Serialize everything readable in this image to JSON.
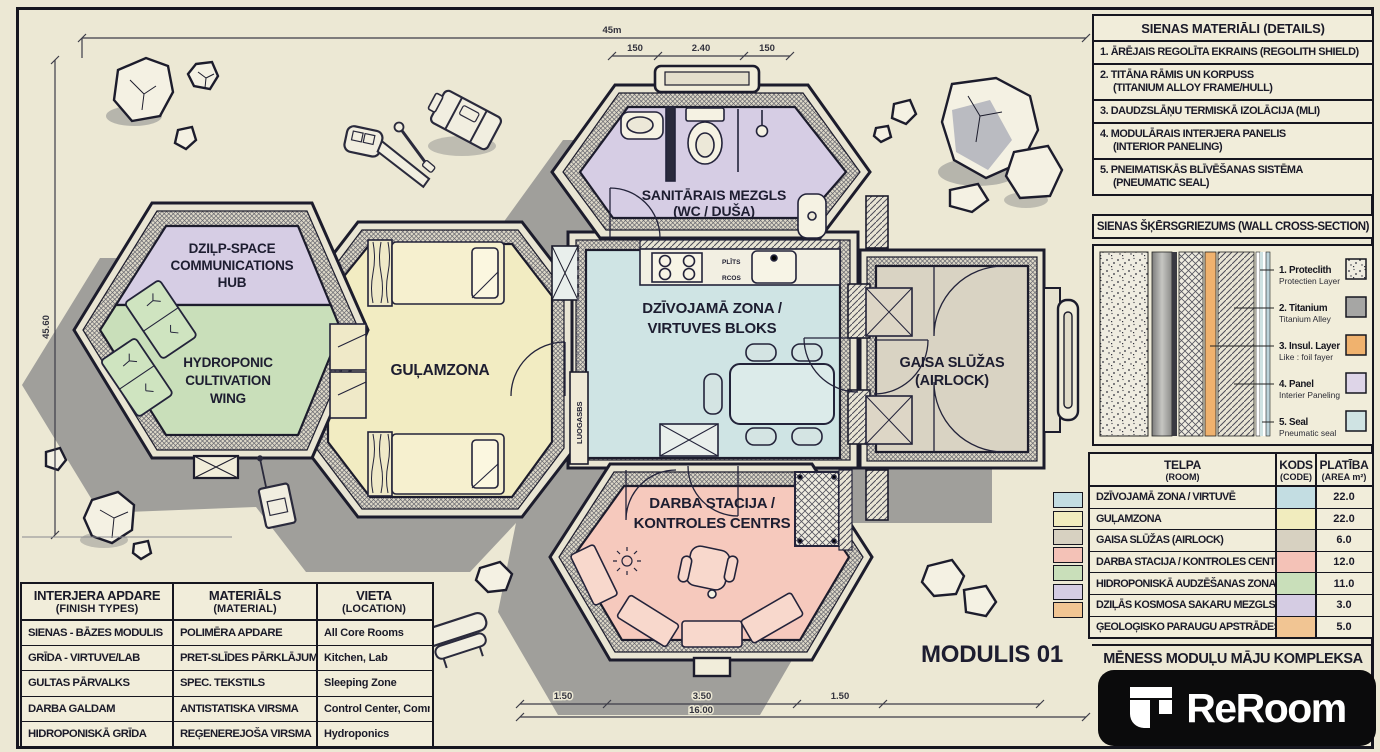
{
  "colors": {
    "paper": "#ede9d6",
    "ink": "#1c1c2c",
    "living": "#cfe4e4",
    "sleep": "#f2ecc2",
    "airlock": "#d9d3c3",
    "work": "#f6c9bd",
    "hydro": "#c9dfba",
    "comms": "#d6cde4",
    "sw_living": "#c3dde2",
    "sw_sleep": "#f1ecbe",
    "sw_airlock": "#d7d1c1",
    "sw_work": "#f4c2b7",
    "sw_hydro": "#c9dfba",
    "sw_comms": "#d5cce3",
    "sw_lab": "#f1c593",
    "cs_titanium": "#a6a6a4",
    "cs_insul": "#f0b26e",
    "cs_panel": "#ded5e8",
    "cs_seal": "#cfe3e3"
  },
  "plan": {
    "module_label": "MODULIS 01",
    "rooms": {
      "comms1": "DZIĻP-SPACE",
      "comms2": "COMMUNICATIONS",
      "comms3": "HUB",
      "hydro1": "HYDROPONIC",
      "hydro2": "CULTIVATION",
      "hydro3": "WING",
      "sleep": "GUĻAMZONA",
      "living1": "DZĪVOJAMĀ ZONA /",
      "living2": "VIRTUVES BLOKS",
      "sanitary1": "SANITĀRAIS MEZGLS",
      "sanitary2": "(WC / DUŠA)",
      "airlock1": "GAISA SLŪŽAS",
      "airlock2": "(AIRLOCK)",
      "work1": "DARBA STACIJA /",
      "work2": "KONTROLES CENTRS"
    },
    "small": {
      "stove": "PLĪTS",
      "counter": "RCOS",
      "duct": "LUOGASBS"
    },
    "dims": {
      "top": "45m",
      "s1": "150",
      "s2": "2.40",
      "s3": "150",
      "left": "45.60",
      "b1": "1.50",
      "b2": "3.50",
      "b3": "1.50",
      "total": "16.00"
    }
  },
  "materials": {
    "title": "SIENAS MATERIĀLI (DETAILS)",
    "items": [
      {
        "l1": "1. ĀRĒJAIS REGOLĪTA EKRAINS (REGOLITH SHIELD)",
        "l2": ""
      },
      {
        "l1": "2. TITĀNA RĀMIS UN KORPUSS",
        "l2": "(TITANIUM ALLOY FRAME/HULL)"
      },
      {
        "l1": "3. DAUDZSLĀŅU TERMISKĀ IZOLĀCIJA (MLI)",
        "l2": ""
      },
      {
        "l1": "4. MODULĀRAIS INTERJERA PANELIS",
        "l2": "(INTERIOR PANELING)"
      },
      {
        "l1": "5. PNEIMATISKĀS BLĪVĒŠANAS SISTĒMA",
        "l2": "(PNEUMATIC SEAL)"
      }
    ]
  },
  "cross_section": {
    "title": "SIENAS ŠĶĒRSGRIEZUMS (WALL CROSS-SECTION)",
    "layers": [
      {
        "name": "1. Proteclith",
        "sub": "Protectien Layer"
      },
      {
        "name": "2. Titanium",
        "sub": "Titanium Alley"
      },
      {
        "name": "3. Insul. Layer",
        "sub": "Like : foil fayer"
      },
      {
        "name": "4. Panel",
        "sub": "Interier Paneling"
      },
      {
        "name": "5. Seal",
        "sub": "Pneumatic seal"
      }
    ]
  },
  "rooms_table": {
    "h_room1": "TELPA",
    "h_room2": "(ROOM)",
    "h_code1": "KODS",
    "h_code2": "(CODE)",
    "h_area1": "PLATĪBA",
    "h_area2": "(AREA m²)",
    "rows": [
      {
        "room": "DZĪVOJAMĀ ZONA / VIRTUVĒ",
        "area": "22.0"
      },
      {
        "room": "GUĻAMZONA",
        "area": "22.0"
      },
      {
        "room": "GAISA SLŪŽAS (AIRLOCK)",
        "area": "6.0"
      },
      {
        "room": "DARBA STACIJA / KONTROLES CENTRS",
        "area": "12.0"
      },
      {
        "room": "HIDROPONISKĀ AUDZĒŠANAS ZONA",
        "area": "11.0"
      },
      {
        "room": "DZIĻĀS KOSMOSA SAKARU MEZGLS",
        "area": "3.0"
      },
      {
        "room": "ĢEOLOĢISKO PARAUGU APSTRĀDES LAB",
        "area": "5.0"
      }
    ]
  },
  "finish_table": {
    "h1a": "INTERJERA APDARE",
    "h1b": "(FINISH TYPES)",
    "h2a": "MATERIĀLS",
    "h2b": "(MATERIAL)",
    "h3a": "VIETA",
    "h3b": "(LOCATION)",
    "rows": [
      {
        "finish": "SIENAS - BĀZES MODULIS",
        "material": "POLIMĒRA APDARE",
        "location": "All Core Rooms"
      },
      {
        "finish": "GRĪDA - VIRTUVE/LAB",
        "material": "PRET-SLĪDES PĀRKLĀJUMS",
        "location": "Kitchen, Lab"
      },
      {
        "finish": "GULTAS PĀRVALKS",
        "material": "SPEC. TEKSTILS",
        "location": "Sleeping Zone"
      },
      {
        "finish": "DARBA GALDAM",
        "material": "ANTISTATISKA VIRSMA",
        "location": "Control Center, Comms"
      },
      {
        "finish": "HIDROPONISKĀ GRĪDA",
        "material": "REĢENEREJOŠA VIRSMA",
        "location": "Hydroponics"
      }
    ]
  },
  "project": {
    "title": "MĒNESS MODUĻU MĀJU KOMPLEKSA",
    "brand": "ReRoom"
  }
}
